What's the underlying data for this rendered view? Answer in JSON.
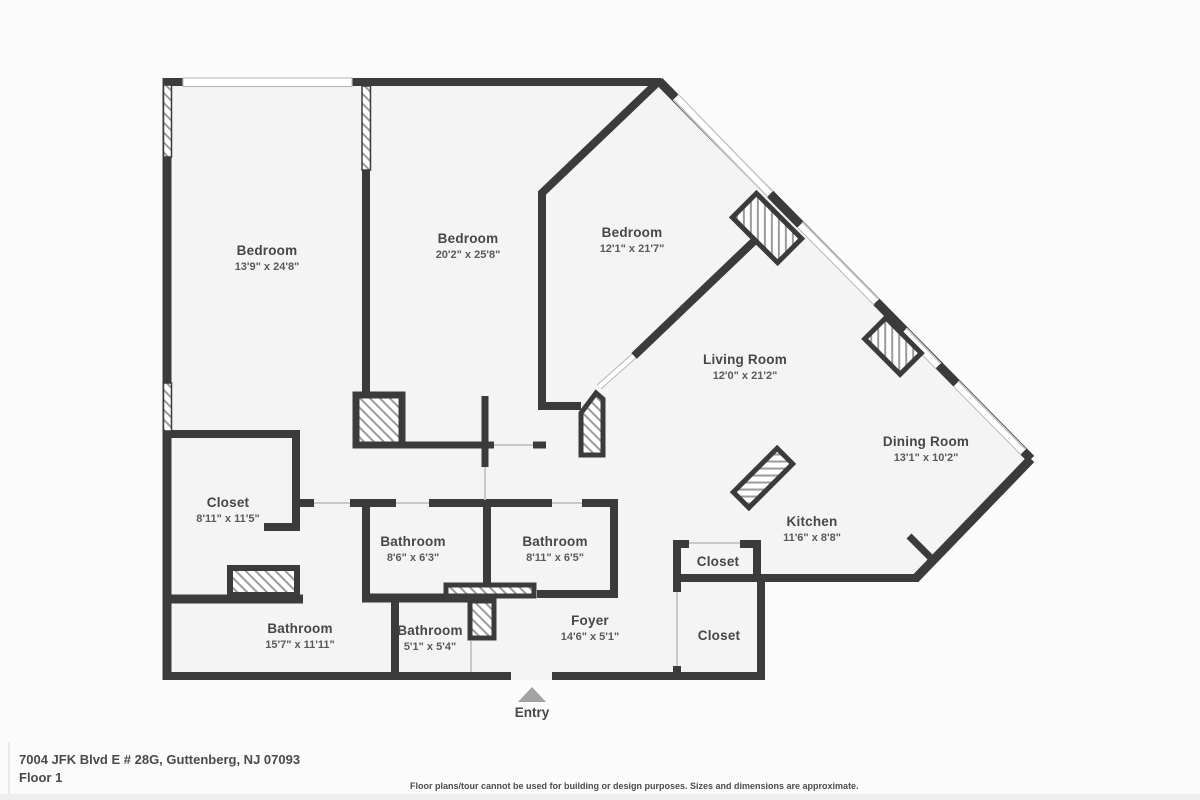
{
  "floorplan": {
    "rooms": [
      {
        "name": "Bedroom",
        "dims": "13'9\" x 24'8\""
      },
      {
        "name": "Bedroom",
        "dims": "20'2\" x 25'8\""
      },
      {
        "name": "Bedroom",
        "dims": "12'1\" x 21'7\""
      },
      {
        "name": "Living Room",
        "dims": "12'0\" x 21'2\""
      },
      {
        "name": "Dining Room",
        "dims": "13'1\" x 10'2\""
      },
      {
        "name": "Kitchen",
        "dims": "11'6\" x 8'8\""
      },
      {
        "name": "Closet",
        "dims": "8'11\" x 11'5\""
      },
      {
        "name": "Bathroom",
        "dims": "8'6\" x 6'3\""
      },
      {
        "name": "Bathroom",
        "dims": "8'11\" x 6'5\""
      },
      {
        "name": "Bathroom",
        "dims": "15'7\" x 11'11\""
      },
      {
        "name": "Bathroom",
        "dims": "5'1\" x 5'4\""
      },
      {
        "name": "Foyer",
        "dims": "14'6\" x 5'1\""
      },
      {
        "name": "Closet",
        "dims": ""
      },
      {
        "name": "Closet",
        "dims": ""
      }
    ],
    "entry_label": "Entry",
    "footer": {
      "address": "7004 JFK Blvd E # 28G, Guttenberg, NJ 07093",
      "floor": "Floor 1",
      "disclaimer": "Floor plans/tour cannot be used for building or design purposes. Sizes and dimensions are approximate."
    },
    "colors": {
      "wall": "#3b3b3b",
      "floor": "#f4f4f4",
      "background": "#fbfbfb",
      "hatch_line": "#9b9b9b",
      "window_line": "#bdbdbd",
      "door_line": "#c9c9c9",
      "entry_arrow": "#a3a3a3",
      "text": "#474747"
    }
  }
}
